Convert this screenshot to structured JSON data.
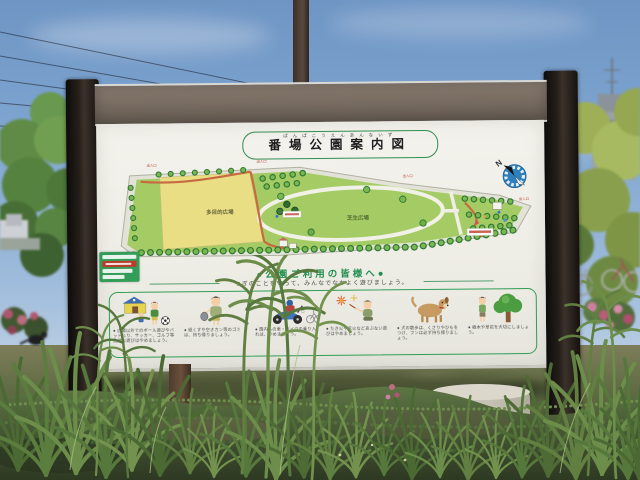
{
  "sign": {
    "title": {
      "kanji": "番場公園案内図",
      "furigana": "ばんばこうえんあんないず"
    },
    "compass": {
      "label": "N"
    },
    "map": {
      "area_labels": {
        "multipurpose": "多目的広場",
        "lawn": "芝生広場"
      },
      "entrance_label": "出入口"
    },
    "notice": {
      "heading": "●公園ご利用の皆様へ●",
      "subheading": "つぎのことを守って、みんなでなかよく遊びましょう。",
      "rules": [
        {
          "icon": "soccer-kids-icon",
          "text": "● 広場以外でのボール遊びやバットふり、サッカー、ゴルフ等危険な遊びはやめましょう。"
        },
        {
          "icon": "trash-bag-icon",
          "text": "● 紙くずや空きカン等のゴミは、持ち帰りましょう。"
        },
        {
          "icon": "motorcycle-icon",
          "text": "● 園内への車・バイクの乗り入れは、やめましょう。"
        },
        {
          "icon": "fireworks-icon",
          "text": "● たき火や花火などあぶない遊びはやめましょう。"
        },
        {
          "icon": "dog-icon",
          "text": "● 犬の散歩は、くさりやひもをつけ、フンは必ず持ち帰りましょう。"
        },
        {
          "icon": "tree-care-icon",
          "text": "● 樹木や草花を大切にしましょう。"
        }
      ]
    },
    "colors": {
      "notice_green": "#1f8f4d",
      "field_yellow": "#ecdf82",
      "lawn_green": "#a5cc62",
      "compass_blue": "#2a7fc0",
      "band_brown": "#7b6f63"
    }
  }
}
